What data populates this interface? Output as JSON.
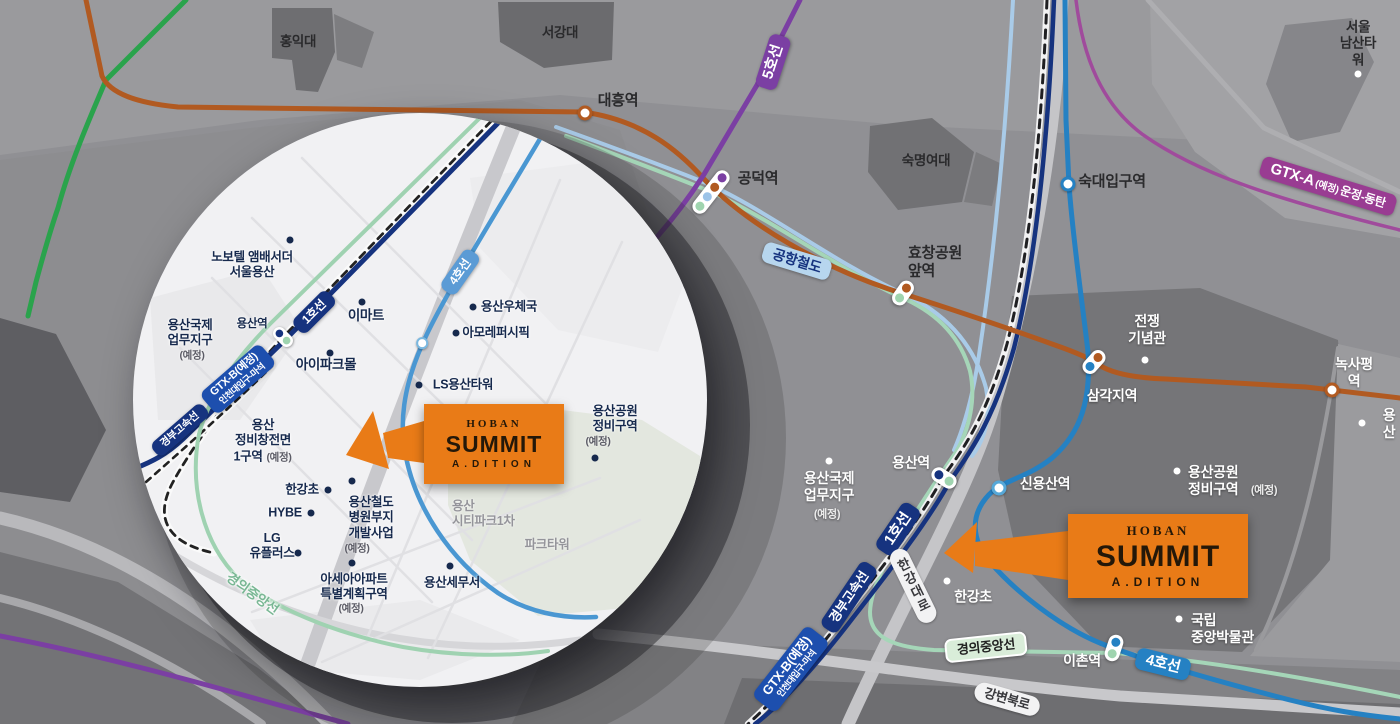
{
  "title": "HOBAN SUMMIT A.DITION 입지 교통 지도",
  "brand": {
    "name": "HOBAN",
    "product": "SUMMIT",
    "sub": "A.DITION"
  },
  "colors": {
    "map_bg": "#909094",
    "inset_bg": "#f1f1f3",
    "hoban_orange": "#e97b17",
    "line1": "#16337f",
    "line2": "#2aa34c",
    "line4": "#2581c3",
    "line5": "#7b3fa3",
    "line6": "#b15a21",
    "gtx_a": "#a04b9c",
    "gtx_b": "#1d4fae",
    "airport_railroad": "#a9cbe8",
    "gyeongui_jungang": "#a5d6b8",
    "inset_text": "#16294d"
  },
  "main": {
    "labels": [
      {
        "text": "홍익대",
        "x": 298,
        "y": 42,
        "style": "dark"
      },
      {
        "text": "서강대",
        "x": 560,
        "y": 33,
        "style": "dark"
      },
      {
        "text": "대흥역",
        "x": 618,
        "y": 101,
        "style": "dark",
        "fs": 15
      },
      {
        "text": "공덕역",
        "x": 758,
        "y": 179,
        "style": "dark",
        "fs": 15
      },
      {
        "text": "숙명여대",
        "x": 926,
        "y": 161,
        "style": "dark"
      },
      {
        "text": "서울\n남산타워",
        "x": 1358,
        "y": 44,
        "style": "dark",
        "bullet": {
          "x": 1358,
          "y": 74,
          "c": "#ffffff"
        }
      },
      {
        "text": "숙대입구역",
        "x": 1112,
        "y": 182,
        "style": "dark",
        "fs": 15
      },
      {
        "text": "효창공원\n앞역",
        "x": 908,
        "y": 263,
        "style": "dark",
        "fs": 15,
        "align": "left"
      },
      {
        "text": "전쟁\n기념관",
        "x": 1147,
        "y": 330,
        "style": "white",
        "bullet": {
          "x": 1145,
          "y": 360,
          "c": "#ffffff"
        }
      },
      {
        "text": "삼각지역",
        "x": 1112,
        "y": 396,
        "style": "white"
      },
      {
        "text": "녹사평역",
        "x": 1354,
        "y": 373,
        "style": "white"
      },
      {
        "text": "용산",
        "x": 1389,
        "y": 424,
        "style": "white",
        "bullet": {
          "x": 1362,
          "y": 423,
          "c": "#ffffff"
        }
      },
      {
        "text": "용산공원\n정비구역",
        "x": 1188,
        "y": 481,
        "style": "white",
        "align": "left",
        "bullet": {
          "x": 1177,
          "y": 471,
          "c": "#ffffff"
        }
      },
      {
        "text": "(예정)",
        "x": 1264,
        "y": 491,
        "style": "whiteParen"
      },
      {
        "text": "용산역",
        "x": 911,
        "y": 463,
        "style": "white"
      },
      {
        "text": "신용산역",
        "x": 1045,
        "y": 484,
        "style": "white"
      },
      {
        "text": "용산국제\n업무지구",
        "x": 829,
        "y": 487,
        "style": "white",
        "bullet": {
          "x": 829,
          "y": 461,
          "c": "#ffffff"
        }
      },
      {
        "text": "(예정)",
        "x": 827,
        "y": 515,
        "style": "whiteParen"
      },
      {
        "text": "한강초",
        "x": 973,
        "y": 597,
        "style": "white",
        "bullet": {
          "x": 947,
          "y": 581,
          "c": "#ffffff"
        }
      },
      {
        "text": "국립\n중앙박물관",
        "x": 1191,
        "y": 629,
        "style": "white",
        "align": "left",
        "bullet": {
          "x": 1179,
          "y": 619,
          "c": "#ffffff"
        }
      },
      {
        "text": "이촌역",
        "x": 1082,
        "y": 661,
        "style": "white"
      }
    ],
    "badges": [
      {
        "text": "5호선",
        "x": 773,
        "y": 62,
        "rot": -72,
        "bg": "#7b3fa3",
        "fg": "#fff",
        "fs": 15
      },
      {
        "main": "GTX-A",
        "paren": "(예정)",
        "route": "운정-동탄",
        "x": 1328,
        "y": 186,
        "rot": 17,
        "bg": "#993c92",
        "fg": "#fff"
      },
      {
        "text": "공항철도",
        "x": 797,
        "y": 261,
        "rot": 17,
        "bg": "#b7d6ee",
        "fg": "#16337f",
        "fs": 14
      },
      {
        "text": "1호선",
        "x": 898,
        "y": 529,
        "rot": -56,
        "bg": "#16337f",
        "fg": "#fff",
        "fs": 15
      },
      {
        "text": "경부고속선",
        "x": 849,
        "y": 597,
        "rot": -56,
        "bg": "#16337f",
        "fg": "#fff",
        "fs": 13
      },
      {
        "text": "GTX-B(예정)",
        "sub": "인천대입구-마석",
        "x": 791,
        "y": 669,
        "rot": -52,
        "bg": "#1d4fae",
        "fg": "#fff",
        "fs": 13
      },
      {
        "text": "4호선",
        "x": 1163,
        "y": 664,
        "rot": 14,
        "bg": "#2581c3",
        "fg": "#fff",
        "fs": 15
      },
      {
        "text": "경의중앙선",
        "x": 986,
        "y": 647,
        "rot": -6,
        "bg": "#d9edd9",
        "fg": "#222",
        "fs": 13,
        "border": "#fff"
      },
      {
        "text": "한강대로",
        "x": 913,
        "y": 586,
        "rot": -26,
        "bg": "#f2f2f3",
        "fg": "#39393d",
        "fs": 13,
        "road": true,
        "vert": true
      },
      {
        "text": "강변북로",
        "x": 1007,
        "y": 699,
        "rot": 16,
        "bg": "#f2f2f3",
        "fg": "#39393d",
        "fs": 13,
        "road": true
      }
    ],
    "stations": [
      {
        "type": "ring",
        "x": 585,
        "y": 113,
        "ring": "#b15a21"
      },
      {
        "type": "pill",
        "x": 711,
        "y": 192,
        "rot": 38,
        "dots": [
          "#7b3fa3",
          "#b15a21",
          "#9cc3e8",
          "#9fd4af"
        ]
      },
      {
        "type": "ring",
        "x": 1068,
        "y": 184,
        "ring": "#2581c3"
      },
      {
        "type": "pill",
        "x": 903,
        "y": 293,
        "rot": 35,
        "dots": [
          "#b15a21",
          "#9fd4af"
        ]
      },
      {
        "type": "pill",
        "x": 1094,
        "y": 362,
        "rot": 42,
        "dots": [
          "#b15a21",
          "#2581c3"
        ]
      },
      {
        "type": "ring",
        "x": 1332,
        "y": 390,
        "ring": "#b15a21"
      },
      {
        "type": "pill",
        "x": 944,
        "y": 478,
        "rot": -58,
        "dots": [
          "#16337f",
          "#9fd4af"
        ]
      },
      {
        "type": "ring",
        "x": 999,
        "y": 488,
        "ring": "#56a8d8"
      },
      {
        "type": "pill",
        "x": 1114,
        "y": 648,
        "rot": 18,
        "dots": [
          "#2581c3",
          "#9fd4af"
        ]
      }
    ]
  },
  "inset": {
    "labels": [
      {
        "text": "노보텔 앰배서더\n서울용산",
        "x": 252,
        "y": 265,
        "style": "inset",
        "bullet": {
          "x": 290,
          "y": 240
        }
      },
      {
        "text": "용산국제\n업무지구",
        "x": 190,
        "y": 333,
        "style": "inset"
      },
      {
        "text": "(예정)",
        "x": 192,
        "y": 356,
        "style": "insetParen"
      },
      {
        "text": "용산역",
        "x": 252,
        "y": 324,
        "style": "inset",
        "fs": 11.5
      },
      {
        "text": "이마트",
        "x": 366,
        "y": 316,
        "style": "inset",
        "fs": 13.5,
        "bullet": {
          "x": 362,
          "y": 302
        }
      },
      {
        "text": "용산우체국",
        "x": 509,
        "y": 307,
        "style": "inset",
        "bullet": {
          "x": 473,
          "y": 307
        }
      },
      {
        "text": "아모레퍼시픽",
        "x": 496,
        "y": 333,
        "style": "inset",
        "bullet": {
          "x": 456,
          "y": 333
        }
      },
      {
        "text": "아이파크몰",
        "x": 326,
        "y": 365,
        "style": "inset",
        "fs": 13.5,
        "bullet": {
          "x": 330,
          "y": 353
        }
      },
      {
        "text": "LS용산타워",
        "x": 463,
        "y": 385,
        "style": "inset",
        "bullet": {
          "x": 419,
          "y": 385
        }
      },
      {
        "text": "용산\n정비창전면",
        "x": 263,
        "y": 433,
        "style": "inset"
      },
      {
        "text": "1구역",
        "x": 248,
        "y": 457,
        "style": "inset"
      },
      {
        "text": "(예정)",
        "x": 279,
        "y": 458,
        "style": "insetParen"
      },
      {
        "text": "한강초",
        "x": 302,
        "y": 490,
        "style": "inset",
        "bullet": {
          "x": 328,
          "y": 490
        }
      },
      {
        "text": "HYBE",
        "x": 285,
        "y": 513,
        "style": "inset",
        "bullet": {
          "x": 311,
          "y": 513
        }
      },
      {
        "text": "LG\n유플러스",
        "x": 272,
        "y": 546,
        "style": "inset",
        "bullet": {
          "x": 298,
          "y": 553
        }
      },
      {
        "text": "용산철도\n병원부지\n개발사업",
        "x": 371,
        "y": 518,
        "style": "inset",
        "bullet": {
          "x": 352,
          "y": 481
        }
      },
      {
        "text": "(예정)",
        "x": 357,
        "y": 549,
        "style": "insetParen"
      },
      {
        "text": "아세아아파트\n특별계획구역",
        "x": 354,
        "y": 587,
        "style": "inset",
        "bullet": {
          "x": 352,
          "y": 563
        }
      },
      {
        "text": "(예정)",
        "x": 351,
        "y": 609,
        "style": "insetParen"
      },
      {
        "text": "용산세무서",
        "x": 452,
        "y": 583,
        "style": "inset",
        "bullet": {
          "x": 450,
          "y": 566
        }
      },
      {
        "text": "용산\n시티파크1차",
        "x": 452,
        "y": 514,
        "style": "insetGray",
        "align": "left"
      },
      {
        "text": "파크타워",
        "x": 547,
        "y": 545,
        "style": "insetGray"
      },
      {
        "text": "용산공원\n정비구역",
        "x": 615,
        "y": 419,
        "style": "inset",
        "bullet": {
          "x": 595,
          "y": 458
        }
      },
      {
        "text": "(예정)",
        "x": 598,
        "y": 442,
        "style": "insetParen"
      },
      {
        "text": "경의중앙선",
        "x": 252,
        "y": 594,
        "style": "greenLine",
        "rot": 36
      }
    ],
    "badges": [
      {
        "text": "1호선",
        "x": 314,
        "y": 312,
        "rot": -45,
        "bg": "#16337f",
        "fg": "#fff",
        "fs": 12
      },
      {
        "text": "4호선",
        "x": 460,
        "y": 272,
        "rot": -55,
        "bg": "#5b9bd5",
        "fg": "#fff",
        "fs": 12
      },
      {
        "text": "경부고속선",
        "x": 180,
        "y": 430,
        "rot": -41,
        "bg": "#16337f",
        "fg": "#fff",
        "fs": 10.5
      },
      {
        "text": "GTX-B(예정)",
        "sub": "인천대입구-마석",
        "x": 238,
        "y": 379,
        "rot": -41,
        "bg": "#1d4fae",
        "fg": "#fff",
        "fs": 11
      }
    ],
    "stations": [
      {
        "type": "pill",
        "x": 283,
        "y": 337,
        "rot": -45,
        "dots": [
          "#16337f",
          "#9fd4af"
        ],
        "small": true
      },
      {
        "type": "ring",
        "x": 422,
        "y": 343,
        "ring": "#7ab8e0",
        "small": true
      }
    ]
  }
}
